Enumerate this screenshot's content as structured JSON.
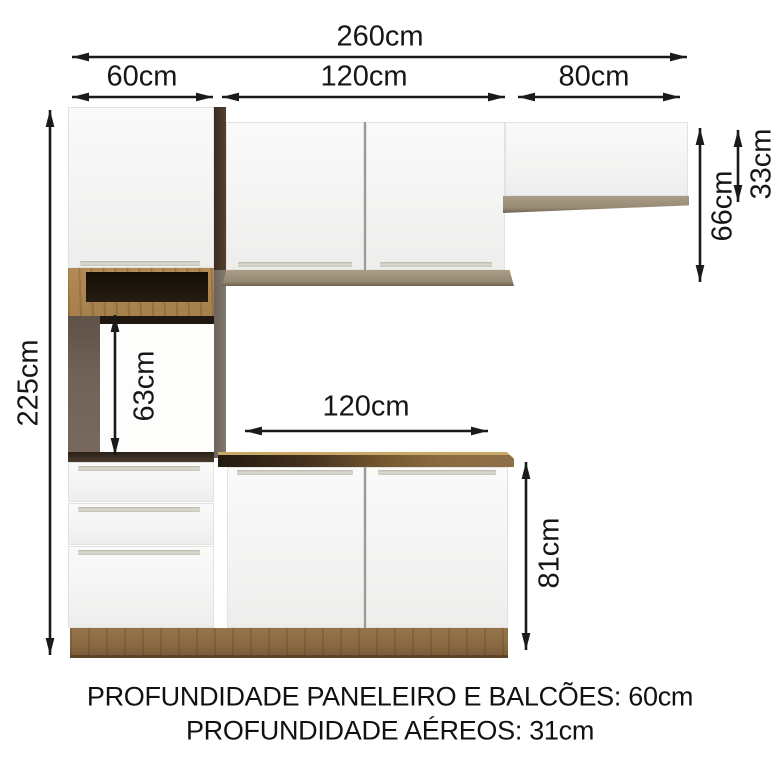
{
  "labels": {
    "total_width": "260cm",
    "pantry_width": "60cm",
    "wall_cabinets_width": "120cm",
    "right_cabinet_width": "80cm",
    "counter_width": "120cm",
    "total_height": "225cm",
    "oven_niche_height": "63cm",
    "wall_cabinet_height": "66cm",
    "right_cabinet_height": "33cm",
    "counter_height": "81cm"
  },
  "footer": {
    "line1": "PROFUNDIDADE PANELEIRO E BALCÕES: 60cm",
    "line2": "PROFUNDIDADE AÉREOS: 31cm"
  },
  "colors": {
    "wood_brown": "#8a6a43",
    "light_wood": "#a5804c",
    "trim_taupe": "#978a73",
    "dark_side_panel": "#47362a",
    "niche_interior": "#20180f",
    "cavity_side_gray": "#6b5e55",
    "door_white": "#f5f5f4",
    "dimension_ink": "#1a1a1a"
  }
}
